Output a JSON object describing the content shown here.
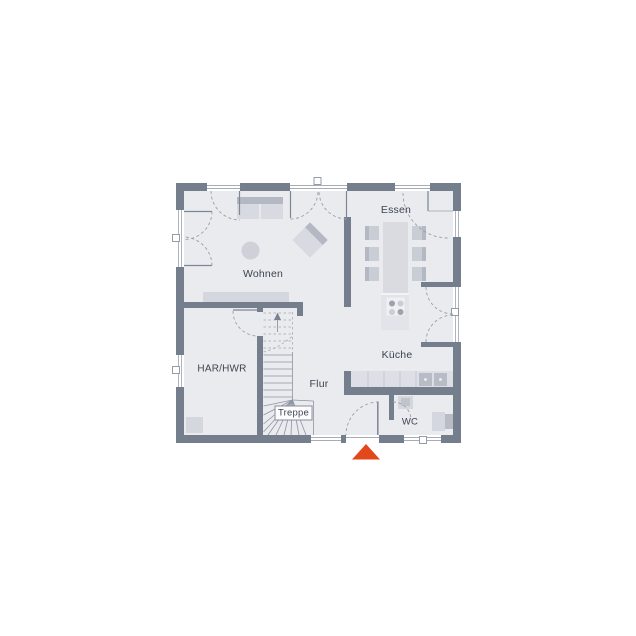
{
  "floorplan": {
    "type": "house-ground-floor-plan",
    "rooms": [
      {
        "key": "wohnen",
        "label": "Wohnen"
      },
      {
        "key": "essen",
        "label": "Essen"
      },
      {
        "key": "kueche",
        "label": "Küche"
      },
      {
        "key": "flur",
        "label": "Flur"
      },
      {
        "key": "har_hwr",
        "label": "HAR/HWR"
      },
      {
        "key": "treppe",
        "label": "Treppe"
      },
      {
        "key": "wc",
        "label": "WC"
      }
    ],
    "entrance": {
      "symbol": "triangle-up",
      "color": "#E2481C"
    },
    "colors": {
      "wall": "#757E8C",
      "floor": "#E9EBEF",
      "window": "#FFFFFF",
      "furniture_light": "#D7DAE0",
      "furniture_mid": "#B3B8C2",
      "counter": "#DCDFE5",
      "island": "#E2E4E9",
      "table": "#D9DBE1",
      "chair": "#C9CDD5",
      "line": "#8B92A0",
      "dash": "#99A0AC",
      "text": "#3D4450"
    }
  }
}
